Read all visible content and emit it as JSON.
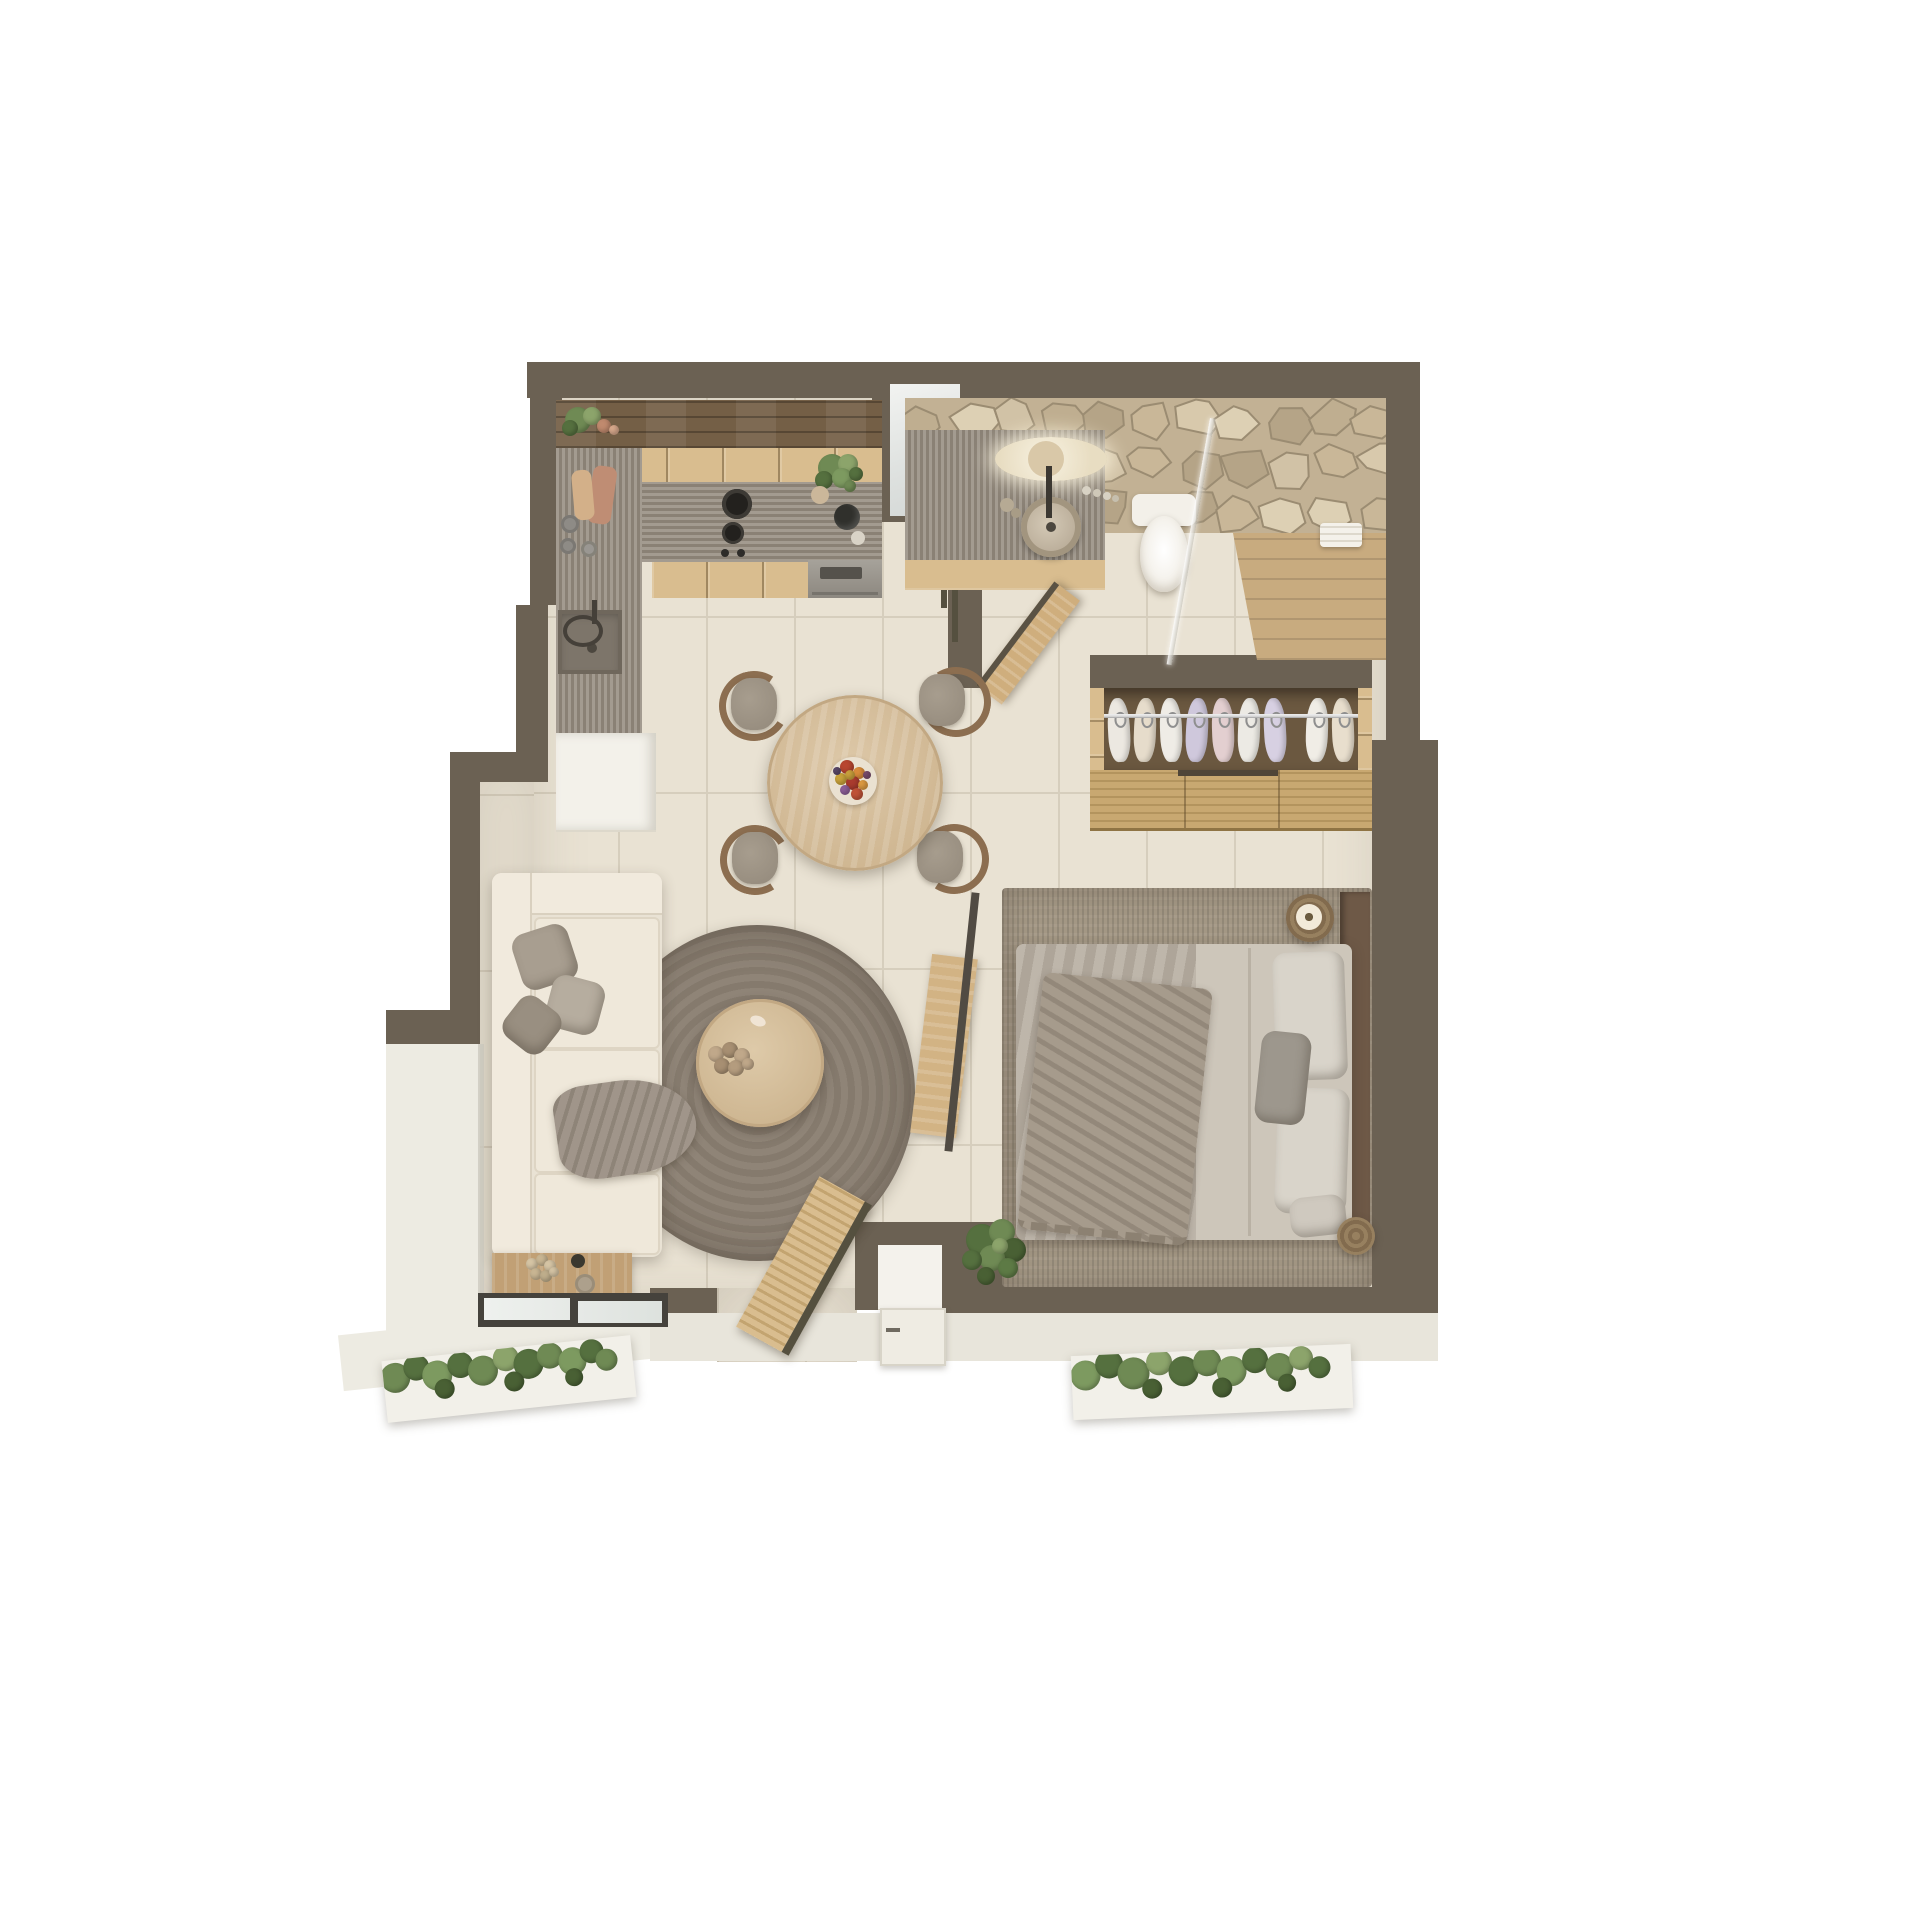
{
  "scene": {
    "type": "3d-top-view-floor-plan",
    "subject": "studio apartment render",
    "rooms": [
      "kitchen",
      "bathroom",
      "shower",
      "hallway",
      "wardrobe",
      "dining-area",
      "living-room",
      "bedroom",
      "entry",
      "terrace",
      "planters"
    ]
  },
  "colors": {
    "wall": "#6b6153",
    "walldark": "#55503f",
    "floor": "#e9e2d3",
    "grout": "#d6cebd",
    "terrace": "#edebe2",
    "walkway": "#e8e5db",
    "darkshelf": "#745f46",
    "lightwood": "#d9bd8f",
    "counter": "#948b7e",
    "sinkbasin": "#7d756a",
    "oven": "#98938b",
    "ovendark": "#55524c",
    "frosted": "#e9eae8",
    "stonebase": "#c2b194",
    "stonestroke": "#9b8c72",
    "mirror": "#f7f1e0",
    "sinkstone": "#c6baa5",
    "toilet": "#f3f0e9",
    "showerwood": "#c8ab7f",
    "frame": "#45423c",
    "glass": "#e6e9e6",
    "wback": "#6b5840",
    "wslat1": "#c8a871",
    "wslat2": "#b3945e",
    "rail": "#d9d9d9",
    "table": "#d8c2a0",
    "plate": "#eae1d1",
    "cushion": "#a79d8e",
    "cushiond": "#93897b",
    "chairwood": "#8c6e50",
    "sofa": "#e9e2d4",
    "sofalight": "#f1ead d",
    "rug1": "#8f8477",
    "rug2": "#857a6d",
    "coffeetable": "#d7c19f",
    "console": "#c1a075",
    "bedrug": "#a39784",
    "duvetl": "#b7aea1",
    "duvetr": "#cdc6ba",
    "bedthrow": "#a69b8c",
    "pillowlight": "#d9d4ca",
    "pillowgray": "#9d978d",
    "headboard": "#6e5947",
    "stump1": "#97805f",
    "stump2": "#826b4e",
    "planter": "#f2f0e9",
    "doorleaf": "#efece3",
    "nichefloor": "#f4f2ec"
  },
  "stone_palette": [
    "#d8c9ac",
    "#c9b798",
    "#bfae90",
    "#d1c2a6",
    "#b5a487",
    "#ddd0b4"
  ],
  "wardrobe": {
    "garments": [
      {
        "x": 18,
        "c": "#ece8e1",
        "t": -3
      },
      {
        "x": 44,
        "c": "#e6dccb",
        "t": 2
      },
      {
        "x": 70,
        "c": "#efece6",
        "t": -2
      },
      {
        "x": 96,
        "c": "#cfc8dc",
        "t": 3
      },
      {
        "x": 122,
        "c": "#e3cfd0",
        "t": -2
      },
      {
        "x": 148,
        "c": "#eceae4",
        "t": 2
      },
      {
        "x": 174,
        "c": "#d7d0e2",
        "t": -3
      },
      {
        "x": 216,
        "c": "#f0ede6",
        "t": 2
      },
      {
        "x": 242,
        "c": "#e8decd",
        "t": -2
      }
    ]
  },
  "fruit_plate": [
    {
      "x": 18,
      "y": 10,
      "r": 7,
      "c": "#b8452f"
    },
    {
      "x": 30,
      "y": 16,
      "r": 6,
      "c": "#d98c3a"
    },
    {
      "x": 12,
      "y": 22,
      "r": 6,
      "c": "#c9a23b"
    },
    {
      "x": 24,
      "y": 26,
      "r": 7,
      "c": "#a93b2e"
    },
    {
      "x": 34,
      "y": 28,
      "r": 5,
      "c": "#dd9a41"
    },
    {
      "x": 16,
      "y": 33,
      "r": 5,
      "c": "#8e5f99"
    },
    {
      "x": 28,
      "y": 37,
      "r": 6,
      "c": "#c05237"
    },
    {
      "x": 8,
      "y": 14,
      "r": 4,
      "c": "#5d4a6b"
    },
    {
      "x": 38,
      "y": 18,
      "r": 4,
      "c": "#7a4e6e"
    },
    {
      "x": 21,
      "y": 18,
      "r": 5,
      "c": "#caa13c"
    }
  ],
  "plants": {
    "kitchen_shelf": [
      {
        "x": 14,
        "y": 12,
        "r": 13,
        "c": "#6f8a54"
      },
      {
        "x": 28,
        "y": 8,
        "r": 9,
        "c": "#8ca46b"
      },
      {
        "x": 6,
        "y": 20,
        "r": 8,
        "c": "#55703f"
      },
      {
        "x": 40,
        "y": 18,
        "r": 7,
        "c": "#c08a6e"
      },
      {
        "x": 50,
        "y": 22,
        "r": 5,
        "c": "#d8a98c"
      }
    ],
    "kitchen_counter": [
      {
        "x": 12,
        "y": 10,
        "r": 14,
        "c": "#6f8a54"
      },
      {
        "x": 28,
        "y": 6,
        "r": 10,
        "c": "#8ca46b"
      },
      {
        "x": 4,
        "y": 22,
        "r": 9,
        "c": "#55703f"
      },
      {
        "x": 22,
        "y": 20,
        "r": 10,
        "c": "#7d9a60"
      },
      {
        "x": 36,
        "y": 16,
        "r": 7,
        "c": "#55703f"
      },
      {
        "x": 30,
        "y": 28,
        "r": 6,
        "c": "#6f8a54"
      }
    ],
    "bedroom_pot": [
      {
        "x": 20,
        "y": 18,
        "r": 16,
        "c": "#55703f"
      },
      {
        "x": 40,
        "y": 10,
        "r": 13,
        "c": "#6f8a54"
      },
      {
        "x": 52,
        "y": 28,
        "r": 12,
        "c": "#496034"
      },
      {
        "x": 30,
        "y": 36,
        "r": 13,
        "c": "#6f8a54"
      },
      {
        "x": 10,
        "y": 38,
        "r": 10,
        "c": "#55703f"
      },
      {
        "x": 46,
        "y": 46,
        "r": 10,
        "c": "#5d7a45"
      },
      {
        "x": 24,
        "y": 54,
        "r": 9,
        "c": "#496034"
      },
      {
        "x": 38,
        "y": 24,
        "r": 8,
        "c": "#8ca46b"
      }
    ],
    "planter_left": [
      {
        "x": 12,
        "y": 18,
        "r": 15,
        "c": "#6f8a54"
      },
      {
        "x": 34,
        "y": 10,
        "r": 13,
        "c": "#55703f"
      },
      {
        "x": 54,
        "y": 20,
        "r": 15,
        "c": "#7d9a60"
      },
      {
        "x": 78,
        "y": 12,
        "r": 13,
        "c": "#55703f"
      },
      {
        "x": 100,
        "y": 20,
        "r": 15,
        "c": "#6f8a54"
      },
      {
        "x": 124,
        "y": 10,
        "r": 13,
        "c": "#8ca46b"
      },
      {
        "x": 146,
        "y": 18,
        "r": 15,
        "c": "#55703f"
      },
      {
        "x": 168,
        "y": 12,
        "r": 13,
        "c": "#6f8a54"
      },
      {
        "x": 190,
        "y": 20,
        "r": 14,
        "c": "#7d9a60"
      },
      {
        "x": 210,
        "y": 12,
        "r": 12,
        "c": "#55703f"
      },
      {
        "x": 224,
        "y": 22,
        "r": 11,
        "c": "#6f8a54"
      },
      {
        "x": 60,
        "y": 34,
        "r": 10,
        "c": "#496034"
      },
      {
        "x": 130,
        "y": 34,
        "r": 10,
        "c": "#496034"
      },
      {
        "x": 190,
        "y": 36,
        "r": 9,
        "c": "#496034"
      }
    ],
    "planter_right": [
      {
        "x": 14,
        "y": 20,
        "r": 15,
        "c": "#7d9a60"
      },
      {
        "x": 38,
        "y": 10,
        "r": 14,
        "c": "#55703f"
      },
      {
        "x": 62,
        "y": 20,
        "r": 16,
        "c": "#6f8a54"
      },
      {
        "x": 88,
        "y": 10,
        "r": 13,
        "c": "#8ca46b"
      },
      {
        "x": 112,
        "y": 20,
        "r": 15,
        "c": "#55703f"
      },
      {
        "x": 136,
        "y": 12,
        "r": 14,
        "c": "#6f8a54"
      },
      {
        "x": 160,
        "y": 22,
        "r": 15,
        "c": "#7d9a60"
      },
      {
        "x": 184,
        "y": 12,
        "r": 13,
        "c": "#55703f"
      },
      {
        "x": 208,
        "y": 20,
        "r": 14,
        "c": "#6f8a54"
      },
      {
        "x": 230,
        "y": 12,
        "r": 12,
        "c": "#8ca46b"
      },
      {
        "x": 248,
        "y": 22,
        "r": 11,
        "c": "#55703f"
      },
      {
        "x": 80,
        "y": 36,
        "r": 10,
        "c": "#496034"
      },
      {
        "x": 150,
        "y": 38,
        "r": 10,
        "c": "#496034"
      },
      {
        "x": 215,
        "y": 36,
        "r": 9,
        "c": "#496034"
      }
    ],
    "console_twigs": [
      {
        "x": 8,
        "y": 8,
        "r": 6,
        "c": "#d6c5a5"
      },
      {
        "x": 18,
        "y": 4,
        "r": 6,
        "c": "#c9b693"
      },
      {
        "x": 26,
        "y": 10,
        "r": 6,
        "c": "#d6c5a5"
      },
      {
        "x": 12,
        "y": 18,
        "r": 6,
        "c": "#c9b693"
      },
      {
        "x": 22,
        "y": 20,
        "r": 6,
        "c": "#bfae8c"
      },
      {
        "x": 30,
        "y": 16,
        "r": 5,
        "c": "#d6c5a5"
      }
    ],
    "coffee_decor": [
      {
        "x": 10,
        "y": 10,
        "r": 8,
        "c": "#c0a88a"
      },
      {
        "x": 24,
        "y": 6,
        "r": 8,
        "c": "#a78f72"
      },
      {
        "x": 36,
        "y": 12,
        "r": 8,
        "c": "#c0a88a"
      },
      {
        "x": 16,
        "y": 22,
        "r": 8,
        "c": "#a78f72"
      },
      {
        "x": 30,
        "y": 24,
        "r": 8,
        "c": "#b49c7e"
      },
      {
        "x": 42,
        "y": 20,
        "r": 6,
        "c": "#c0a88a"
      }
    ]
  }
}
